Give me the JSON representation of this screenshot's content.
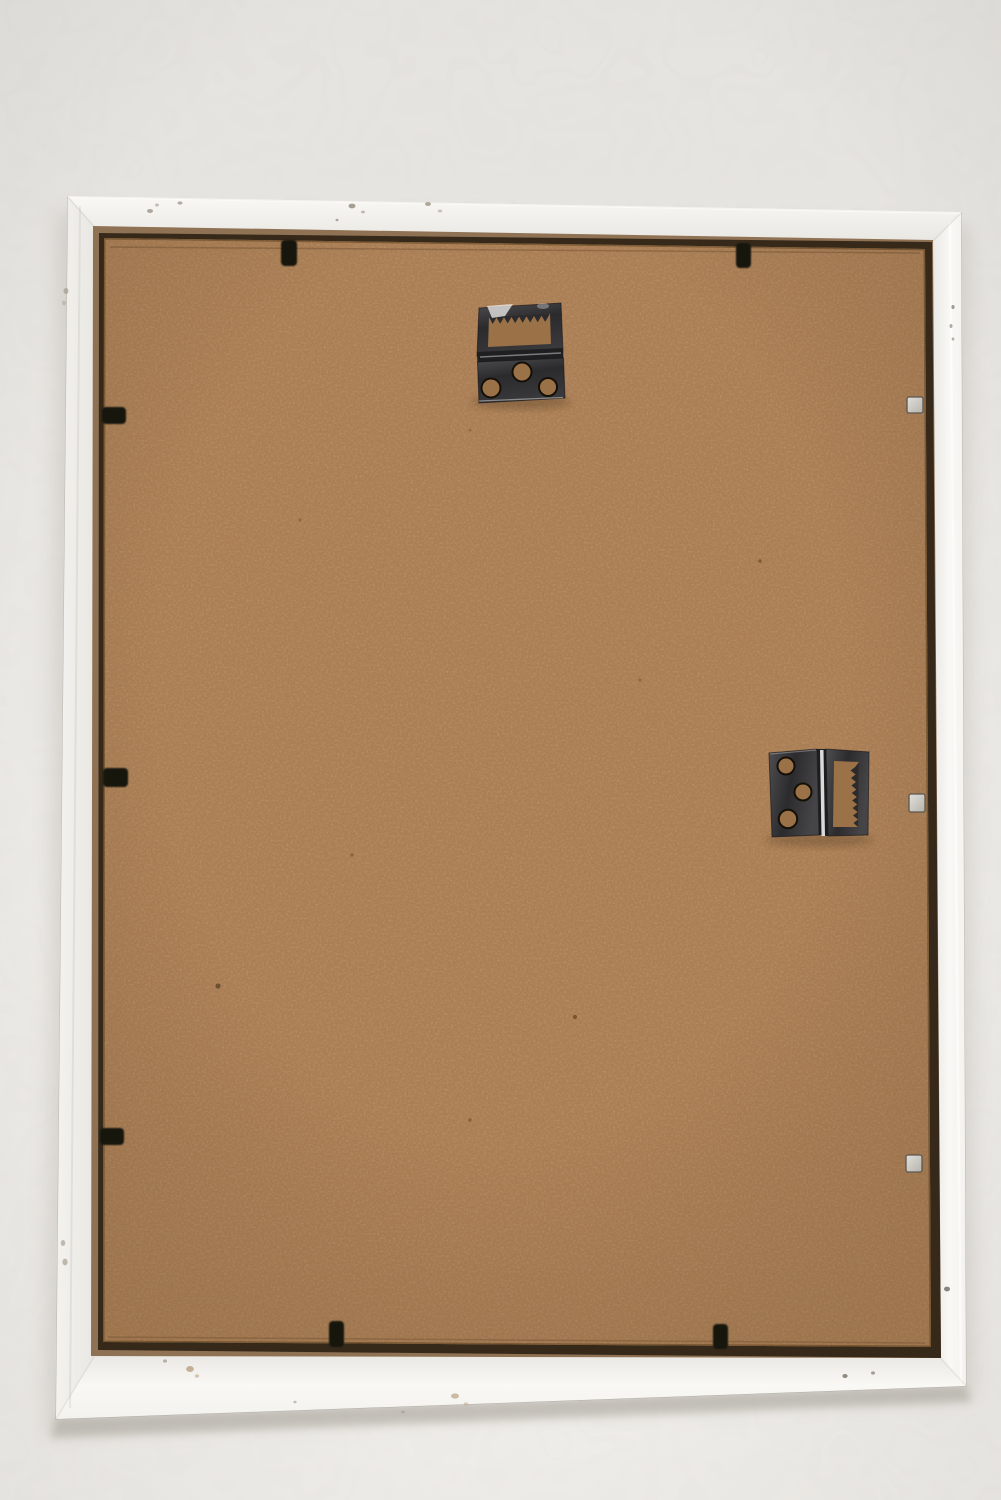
{
  "scene": {
    "title": "Back view of an empty white wooden picture frame hanging against a light wall",
    "type": "photograph",
    "objects": {
      "wall": {
        "label": "plain light warm-gray wall"
      },
      "frame": {
        "label": "white painted wooden frame with small paint chips"
      },
      "backing": {
        "label": "brown MDF hardboard backing panel"
      },
      "hanger_top": {
        "label": "metal sawtooth hanger hinge, top center",
        "screw_holes": 3,
        "orientation": "horizontal"
      },
      "hanger_right": {
        "label": "metal sawtooth hanger hinge, middle right",
        "screw_holes": 3,
        "orientation": "vertical"
      },
      "black_tabs": {
        "label": "black flexi retaining tabs around edges",
        "count": 7
      },
      "silver_clips": {
        "label": "small silver metal clips on right edge",
        "count": 3
      }
    },
    "colors": {
      "wall_top": "#e5e3df",
      "wall_mid": "#eae8e4",
      "wall_bottom": "#f0eeea",
      "frame_bright": "#f9f8f5",
      "frame_base": "#f3f2ee",
      "frame_shade": "#e8e6e1",
      "rebate_tan": "#8f7253",
      "rebate_shadow": "#2f2316",
      "backing_base": "#aa7d53",
      "backing_fiber_dark": "#7d5a39",
      "backing_fiber_light": "#c69a6b",
      "hole_brown": "#9b7147",
      "metal_dark": "#2b2a2c",
      "metal_mid": "#4e4d50",
      "metal_highlight": "#d6d5d4",
      "metal_specular": "#f0efed",
      "tab_black": "#16120d",
      "clip_silver_light": "#e2e0db",
      "clip_silver_dark": "#b5b2ab",
      "clip_silver_edge": "#5b574f"
    }
  }
}
